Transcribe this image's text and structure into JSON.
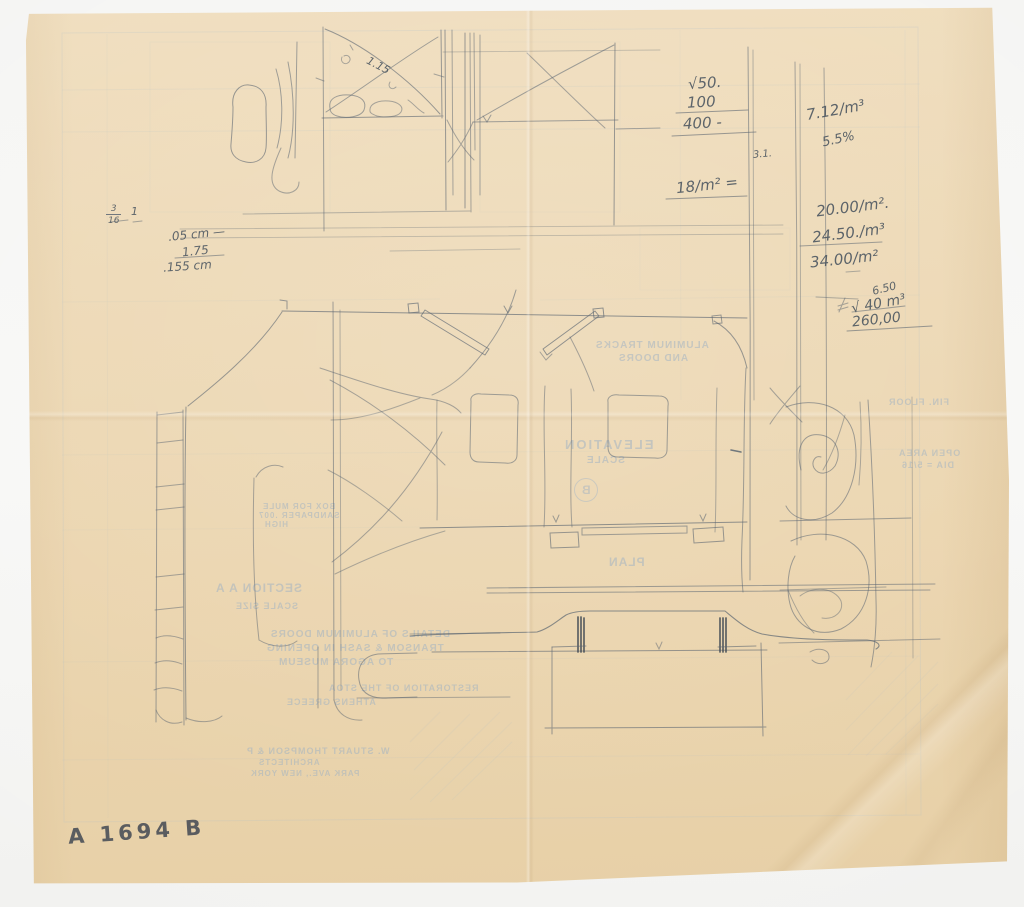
{
  "sheet": {
    "id_label": "A 1694 B"
  },
  "pencil_notes": {
    "sqrt50": "√50.",
    "n100": "100",
    "n400": "400 -",
    "rate712": "7.12/m³",
    "pct55": "5.5%",
    "small31": "3.1.",
    "rate18": "18/m² =",
    "price20": "20.00/m².",
    "price2450": "24.50./m³",
    "price34": "34.00/m²",
    "small650": "6.50",
    "vol40": "√ 40 m³",
    "total260": "260,00",
    "frac_num": "3",
    "frac_den": "16",
    "one": "1",
    "cm05": ".05 cm —",
    "n175": "1.75",
    "cm155": ".155 cm",
    "diag115": "1.15"
  },
  "showthrough": {
    "fin_floor": "FIN. FLOOR",
    "open_area": "OPEN AREA",
    "dia": "DIA = 5/16",
    "aluminum_tracks": "ALUMINUM TRACKS",
    "and_doors": "AND DOORS",
    "elevation": "ELEVATION",
    "scale": "SCALE",
    "detail_b": "B",
    "plan": "PLAN",
    "section_aa": "SECTION A A",
    "scale_size": "SCALE SIZE",
    "box_note1": "BOX FOR MULE",
    "box_note2": "SANDPAPER .007",
    "box_note3": "HIGH",
    "details1": "DETAILS OF ALUMINUM DOORS",
    "details2": "TRANSOM & SASH IN OPENING",
    "details3": "TO AGORA MUSEUM",
    "restoration": "RESTORATION OF THE STOA",
    "athens": "ATHENS GREECE",
    "architect1": "W. STUART THOMPSON & P",
    "architect2": "ARCHITECTS",
    "architect3": "PARK AVE., NEW YORK"
  }
}
